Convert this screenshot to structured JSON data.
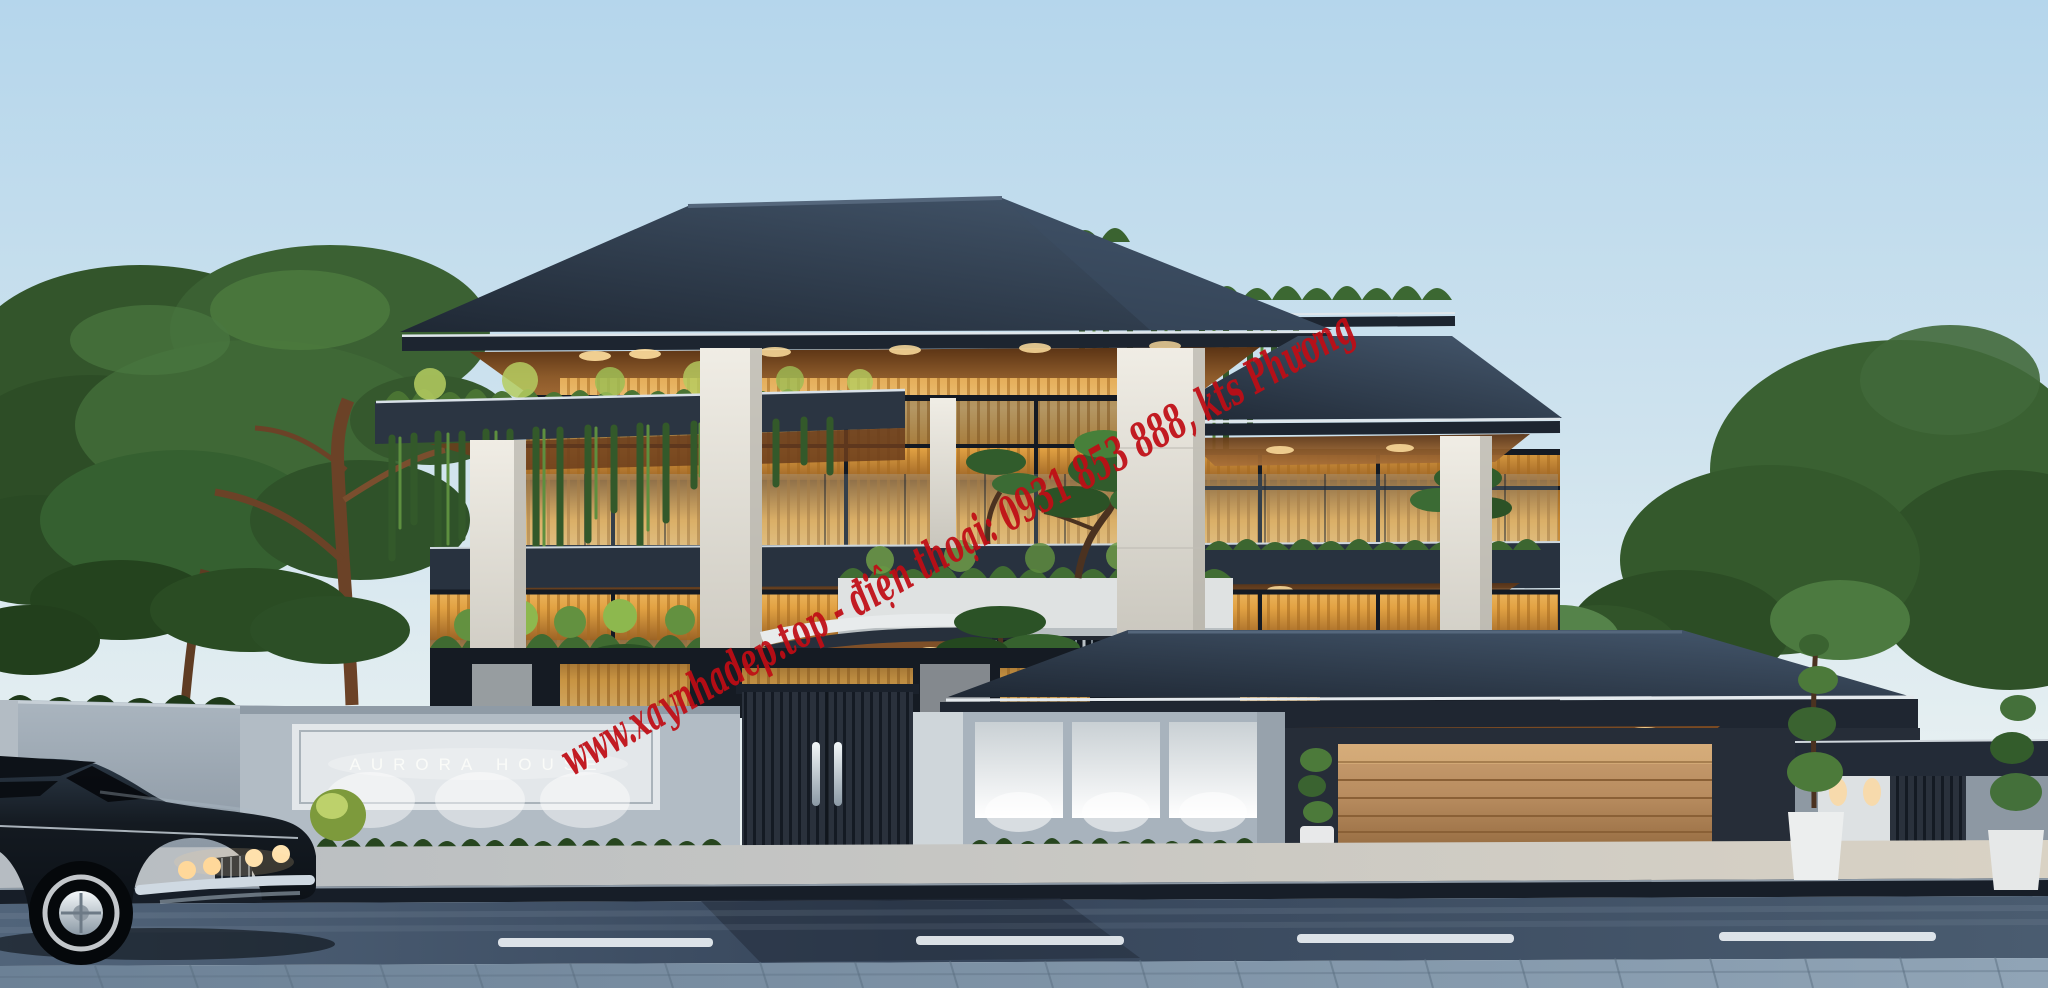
{
  "scene": {
    "type": "exterior-architectural-rendering",
    "time_of_day": "dusk",
    "watermark": {
      "text": "www.xaynhadep.top - điện thoại: 0931 853 888, kts Phương",
      "color": "#c00d15"
    },
    "sign": {
      "text": "AURORA HOUSE",
      "color": "#fbfcf9"
    },
    "palette": {
      "sky_top": "#b5d6ec",
      "sky_horizon": "#f1f4f1",
      "roof": "#2c3a4c",
      "fascia_highlight": "#e2e8ec",
      "soffit_wood": "#8c5a2a",
      "marble": "#e9e6de",
      "window_glow": "#f3c06c",
      "foliage": "#4a7a38",
      "fence": "#aab5bf",
      "gate": "#2a313c",
      "garage_door": "#b98d60",
      "road": "#36455a",
      "road_marking": "#e9eff3",
      "paver_sidewalk": "#7e94a9",
      "car_body": "#141a21",
      "chrome": "#cfd9e2",
      "headlight": "#ffd89a"
    }
  }
}
